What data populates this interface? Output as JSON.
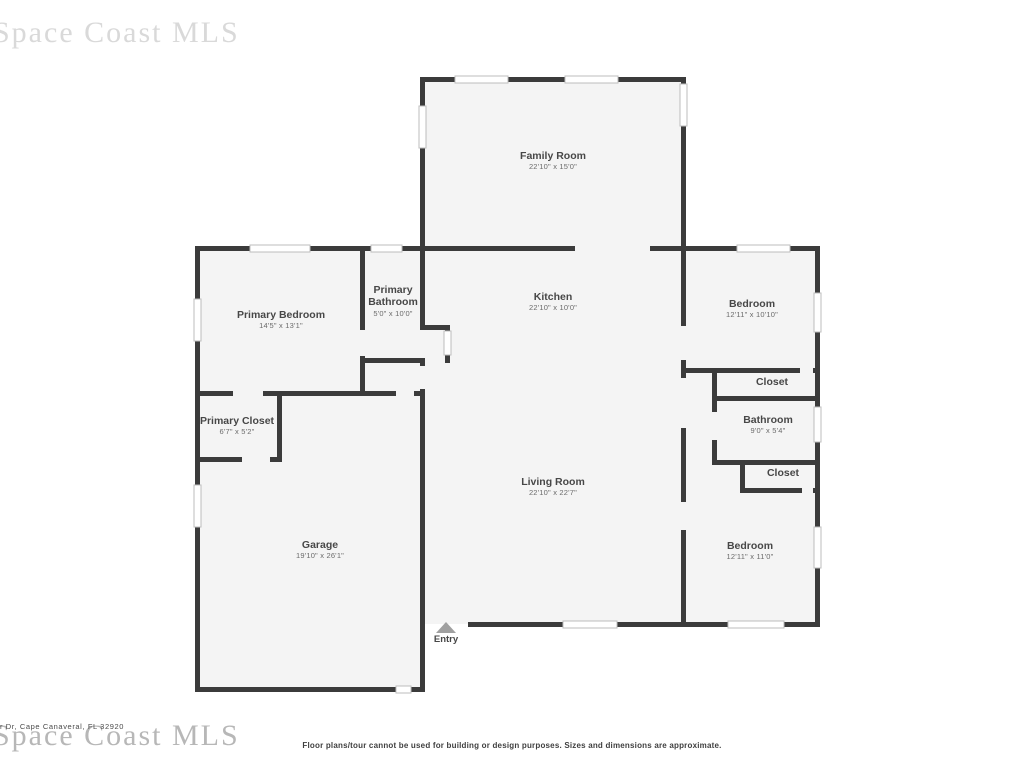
{
  "watermarks": {
    "top_left": "Space Coast MLS",
    "bottom_left": "Space Coast MLS"
  },
  "footer": {
    "address": "r Dr, Cape Canaveral, FL 32920",
    "disclaimer": "Floor plans/tour cannot be used for building or design purposes. Sizes and dimensions are approximate."
  },
  "floor_plan": {
    "entry_label": "Entry",
    "rooms": [
      {
        "name": "Family Room",
        "dims": "22'10\" x 15'0\""
      },
      {
        "name": "Primary Bedroom",
        "dims": "14'5\" x 13'1\""
      },
      {
        "name": "Primary Bathroom",
        "dims": "5'0\" x 10'0\""
      },
      {
        "name": "Kitchen",
        "dims": "22'10\" x 10'0\""
      },
      {
        "name": "Bedroom",
        "dims": "12'11\" x 10'10\""
      },
      {
        "name": "Closet",
        "dims": ""
      },
      {
        "name": "Bathroom",
        "dims": "9'0\" x 5'4\""
      },
      {
        "name": "Closet",
        "dims": ""
      },
      {
        "name": "Primary Closet",
        "dims": "6'7\" x 5'2\""
      },
      {
        "name": "Living Room",
        "dims": "22'10\" x 22'7\""
      },
      {
        "name": "Garage",
        "dims": "19'10\" x 26'1\""
      },
      {
        "name": "Bedroom",
        "dims": "12'11\" x 11'0\""
      }
    ],
    "colors": {
      "wall": "#3b3b3b",
      "room_fill": "#f4f4f4",
      "window_trim": "#bdbdbd",
      "label_text": "#474747",
      "dims_text": "#6b6b6b",
      "entry_arrow": "#a0a0a0"
    }
  }
}
